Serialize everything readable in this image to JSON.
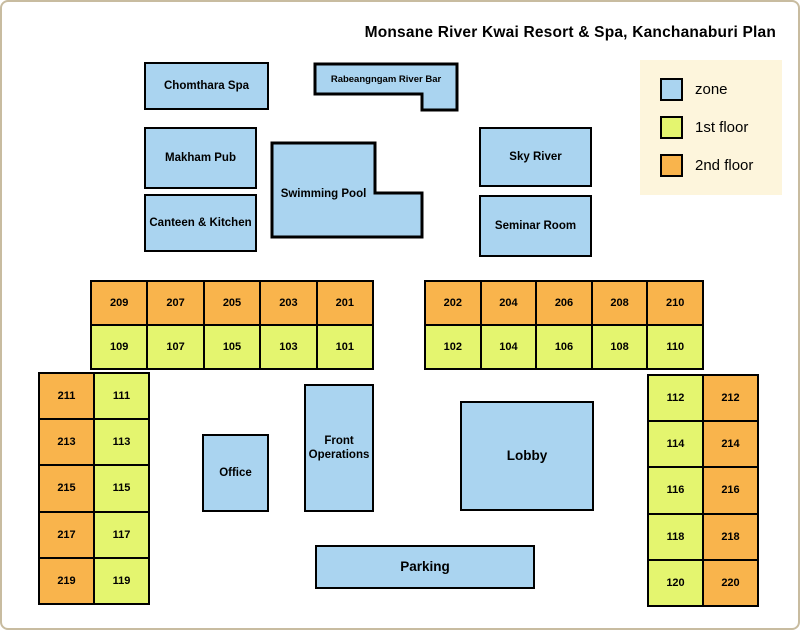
{
  "title": "Monsane River Kwai Resort & Spa, Kanchanaburi Plan",
  "colors": {
    "zone": "#AAD4F0",
    "floor1": "#E4F56F",
    "floor2": "#F9B44C",
    "legend_bg": "#FDF5DC",
    "frame": "#C8BCA0",
    "outline": "#000000"
  },
  "legend": {
    "items": [
      {
        "label": "zone",
        "type": "zone"
      },
      {
        "label": "1st floor",
        "type": "floor1"
      },
      {
        "label": "2nd floor",
        "type": "floor2"
      }
    ]
  },
  "zones": {
    "chomthara_spa": "Chomthara Spa",
    "river_bar": "Rabeangngam River Bar",
    "makham_pub": "Makham Pub",
    "swimming_pool": "Swimming Pool",
    "sky_river": "Sky River",
    "canteen_kitchen": "Canteen & Kitchen",
    "seminar_room": "Seminar Room",
    "office": "Office",
    "front_operations": "Front Operations",
    "lobby": "Lobby",
    "parking": "Parking"
  },
  "room_blocks": [
    {
      "id": "north-west",
      "orientation": "horizontal",
      "lines": [
        {
          "floor": "floor2",
          "rooms": [
            "209",
            "207",
            "205",
            "203",
            "201"
          ]
        },
        {
          "floor": "floor1",
          "rooms": [
            "109",
            "107",
            "105",
            "103",
            "101"
          ]
        }
      ]
    },
    {
      "id": "north-east",
      "orientation": "horizontal",
      "lines": [
        {
          "floor": "floor2",
          "rooms": [
            "202",
            "204",
            "206",
            "208",
            "210"
          ]
        },
        {
          "floor": "floor1",
          "rooms": [
            "102",
            "104",
            "106",
            "108",
            "110"
          ]
        }
      ]
    },
    {
      "id": "west-wing",
      "orientation": "vertical",
      "lines": [
        {
          "floor": "floor2",
          "rooms": [
            "211",
            "213",
            "215",
            "217",
            "219"
          ]
        },
        {
          "floor": "floor1",
          "rooms": [
            "111",
            "113",
            "115",
            "117",
            "119"
          ]
        }
      ]
    },
    {
      "id": "east-wing",
      "orientation": "vertical",
      "lines": [
        {
          "floor": "floor1",
          "rooms": [
            "112",
            "114",
            "116",
            "118",
            "120"
          ]
        },
        {
          "floor": "floor2",
          "rooms": [
            "212",
            "214",
            "216",
            "218",
            "220"
          ]
        }
      ]
    }
  ]
}
